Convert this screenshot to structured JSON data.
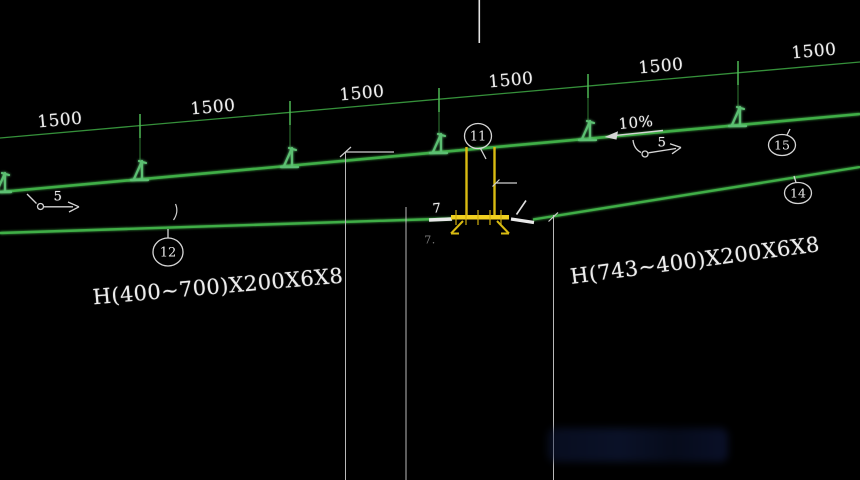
{
  "drawing": {
    "spacing_labels": [
      "1500",
      "1500",
      "1500",
      "1500",
      "1500",
      "1500"
    ],
    "slope_label": "10%",
    "weld_size_left": "5",
    "weld_size_right": "5",
    "weld_size_plate": "7",
    "plate_note": "7.",
    "beam_label_left": "H(400~700)X200X6X8",
    "beam_label_right": "H(743~400)X200X6X8",
    "bubbles": {
      "top": "11",
      "mid_left": "12",
      "right_lower": "14",
      "right_upper": "15"
    },
    "colors": {
      "background": "#000000",
      "member_green": "#3fae46",
      "dimension_green": "#35903a",
      "clip_green": "#5bbf72",
      "highlight_yellow": "#e9c91c",
      "annotation_white": "#d9d9d9",
      "text_white": "#ededed"
    }
  }
}
